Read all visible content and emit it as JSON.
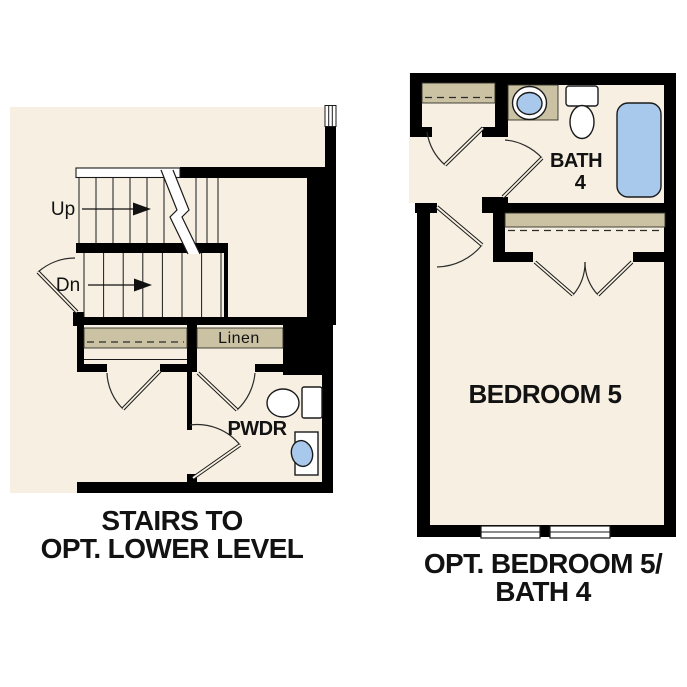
{
  "colors": {
    "floor_cream": "#f7f0e2",
    "closet_tan": "#cbc2a4",
    "fixture_blue": "#a9c9ec",
    "wall_black": "#000000"
  },
  "left_plan": {
    "up_label": "Up",
    "dn_label": "Dn",
    "linen_label": "Linen",
    "pwdr_label": "PWDR",
    "caption_line1": "STAIRS TO",
    "caption_line2": "OPT. LOWER LEVEL"
  },
  "right_plan": {
    "bath_label_line1": "BATH",
    "bath_label_line2": "4",
    "bedroom_label": "BEDROOM 5",
    "caption_line1": "OPT. BEDROOM 5/",
    "caption_line2": "BATH 4"
  }
}
